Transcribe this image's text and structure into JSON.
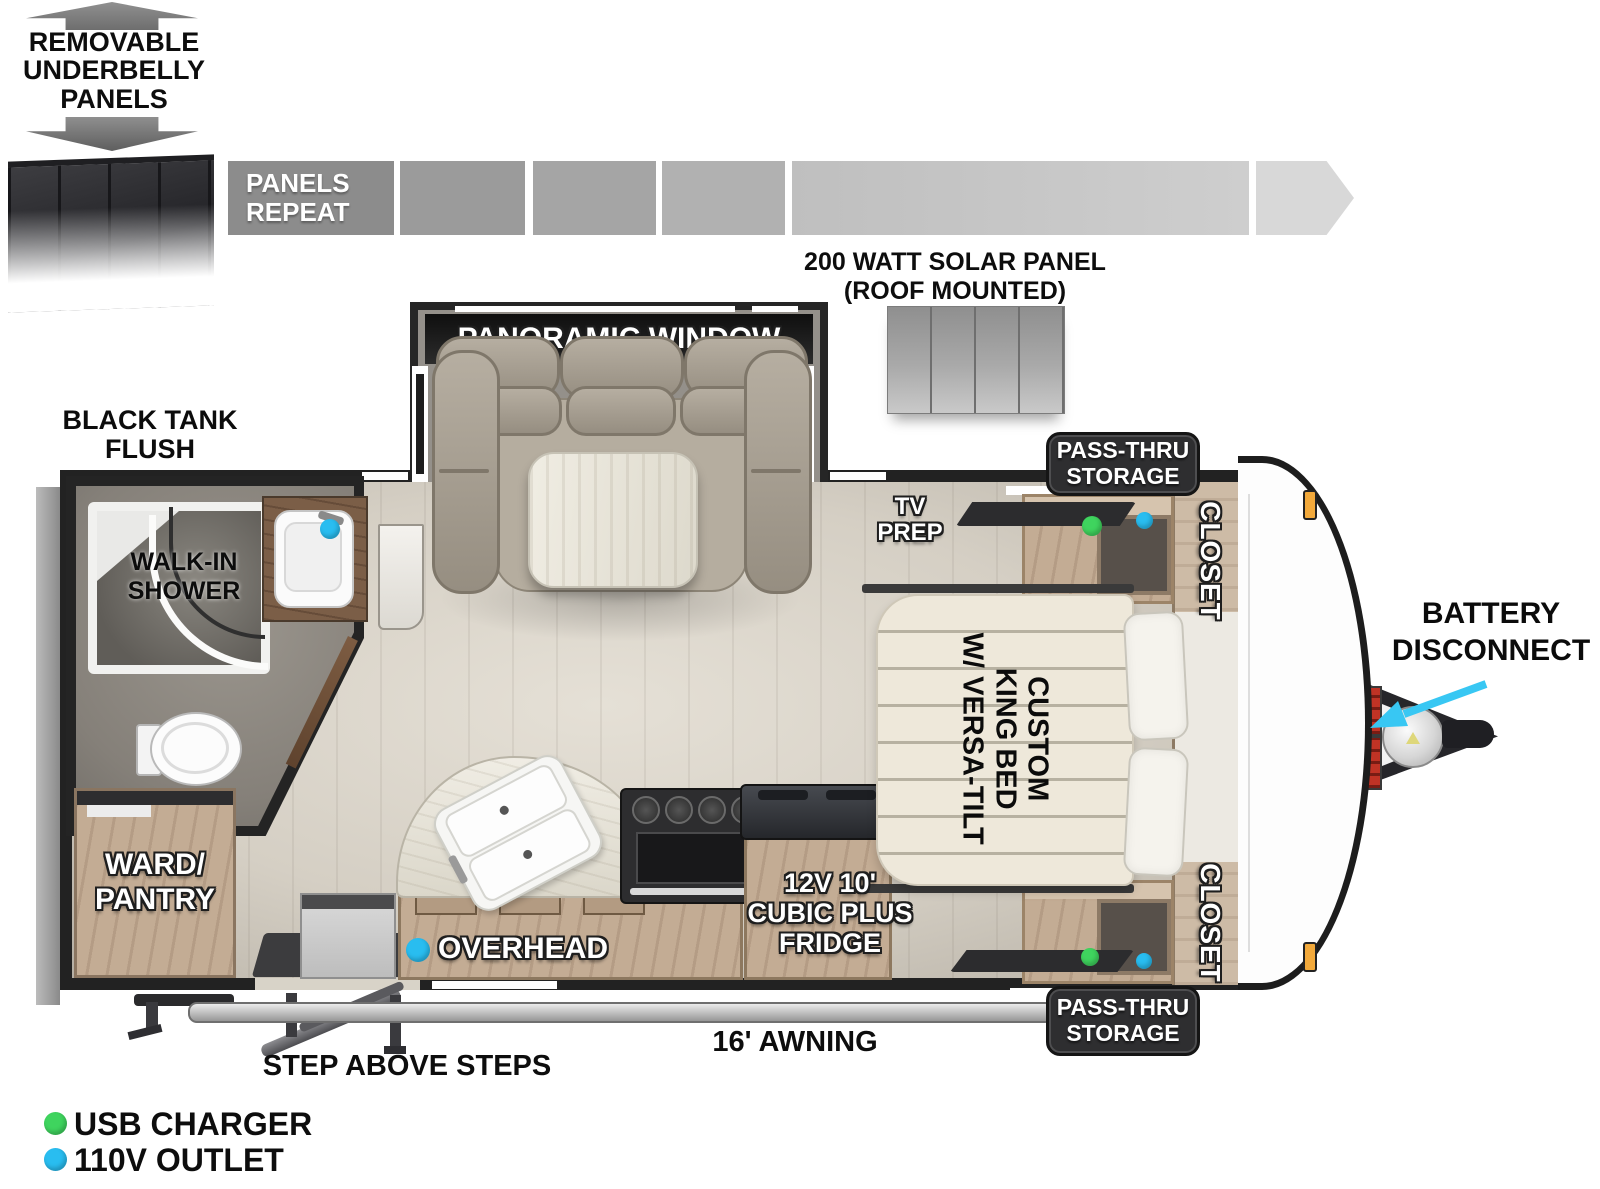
{
  "title": "Travel trailer floor plan diagram",
  "underbelly_callout": {
    "lines": [
      "REMOVABLE",
      "UNDERBELLY",
      "PANELS"
    ]
  },
  "panels_strip": {
    "label_lines": [
      "PANELS",
      "REPEAT"
    ]
  },
  "solar_panel": {
    "label_lines": [
      "200 WATT SOLAR PANEL",
      "(ROOF MOUNTED)"
    ]
  },
  "slide_out": {
    "window_label": "PANORAMIC WINDOW"
  },
  "bathroom": {
    "black_tank_flush_lines": [
      "BLACK TANK",
      "FLUSH"
    ],
    "shower_lines": [
      "WALK-IN",
      "SHOWER"
    ]
  },
  "bedroom": {
    "tv_prep_lines": [
      "TV",
      "PREP"
    ],
    "bed_lines": [
      "CUSTOM",
      "KING BED",
      "W/ VERSA-TILT"
    ],
    "closet_top": "CLOSET",
    "closet_bottom": "CLOSET",
    "pass_thru_top_lines": [
      "PASS-THRU",
      "STORAGE"
    ],
    "pass_thru_bottom_lines": [
      "PASS-THRU",
      "STORAGE"
    ]
  },
  "kitchen": {
    "overhead_label": "OVERHEAD",
    "fridge_lines": [
      "12V 10'",
      "CUBIC PLUS",
      "FRIDGE"
    ]
  },
  "storage": {
    "ward_pantry_lines": [
      "WARD/",
      "PANTRY"
    ]
  },
  "exterior": {
    "awning_label": "16' AWNING",
    "steps_label": "STEP ABOVE STEPS",
    "battery_disconnect_lines": [
      "BATTERY",
      "DISCONNECT"
    ]
  },
  "legend": {
    "items": [
      {
        "label": "USB CHARGER",
        "color": "#3fd45e"
      },
      {
        "label": "110V OUTLET",
        "color": "#29bdf0"
      }
    ]
  },
  "colors": {
    "usb_charger_green": "#3fd45e",
    "outlet_110v_blue": "#29bdf0",
    "pointer_arrow_cyan": "#38c7f3",
    "marker_light_orange": "#f2a93b",
    "wall_dark": "#222222"
  }
}
